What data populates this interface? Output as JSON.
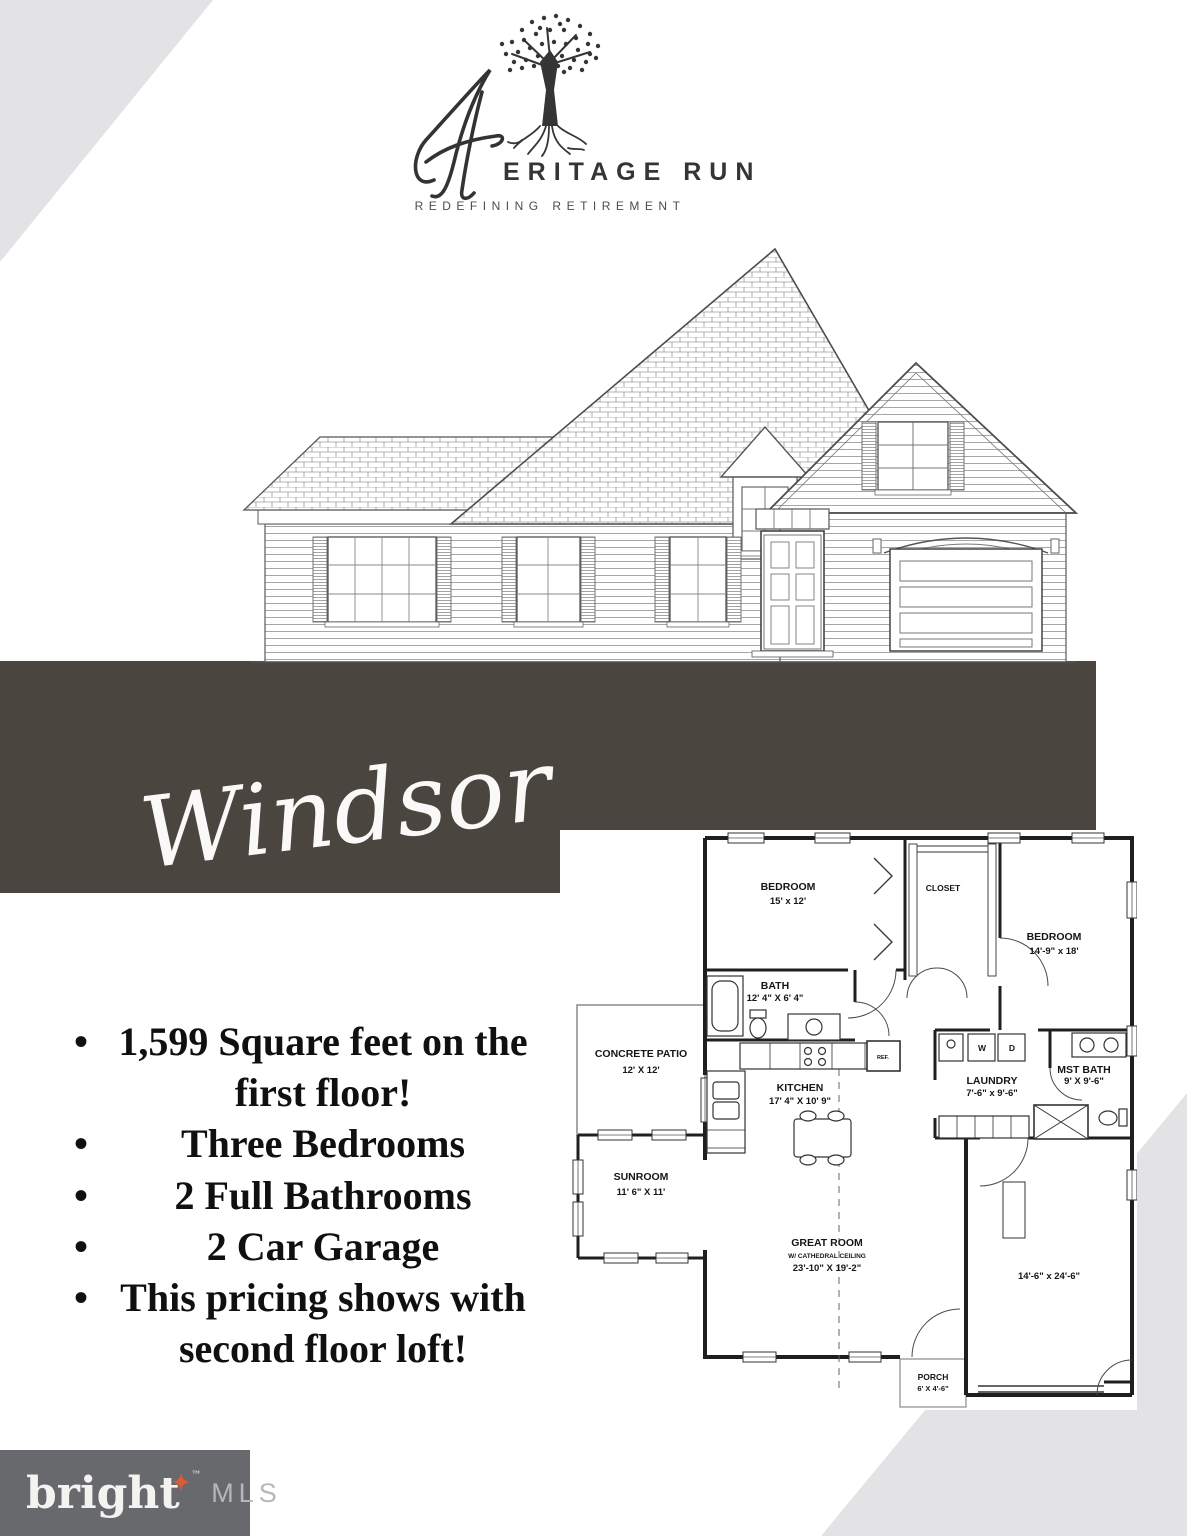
{
  "page": {
    "background": "#ffffff",
    "corner_triangle_color": "#e3e3e5",
    "banner_color": "#4a453f"
  },
  "logo": {
    "script_initial": "H",
    "wordmark": "ERITAGE RUN",
    "tagline": "REDEFINING RETIREMENT",
    "tree_icon": "oak-tree-with-roots"
  },
  "plan": {
    "name": "Windsor"
  },
  "features": {
    "items": [
      "1,599 Square feet on the first floor!",
      "Three Bedrooms",
      "2 Full Bathrooms",
      "2 Car Garage",
      "This pricing shows with second floor loft!"
    ]
  },
  "floorplan": {
    "rooms": {
      "bedroom1": {
        "name": "BEDROOM",
        "dims": "15' x 12'"
      },
      "closet": {
        "name": "CLOSET"
      },
      "bedroom2": {
        "name": "BEDROOM",
        "dims": "14'-9\" x 18'"
      },
      "bath": {
        "name": "BATH",
        "dims": "12' 4\" X 6' 4\""
      },
      "patio": {
        "name": "CONCRETE PATIO",
        "dims": "12' X 12'"
      },
      "kitchen": {
        "name": "KITCHEN",
        "dims": "17' 4\" X 10' 9\""
      },
      "laundry": {
        "name": "LAUNDRY",
        "dims": "7'-6\" x 9'-6\""
      },
      "mst_bath": {
        "name": "MST BATH",
        "dims": "9' X 9'-6\""
      },
      "sunroom": {
        "name": "SUNROOM",
        "dims": "11' 6\" X 11'"
      },
      "great_room": {
        "name": "GREAT ROOM",
        "sub": "W/ CATHEDRAL CEILING",
        "dims": "23'-10\" X 19'-2\""
      },
      "garage": {
        "dims": "14'-6\" x 24'-6\""
      },
      "porch": {
        "name": "PORCH",
        "dims": "6' X 4'-6\""
      }
    },
    "labels": {
      "ref": "REF.",
      "washer": "W",
      "dryer": "D"
    }
  },
  "footer": {
    "brand": "bright",
    "trademark": "™",
    "suffix": "MLS",
    "star": "✦",
    "bar_color": "#68696d",
    "star_color": "#dc5b31"
  }
}
